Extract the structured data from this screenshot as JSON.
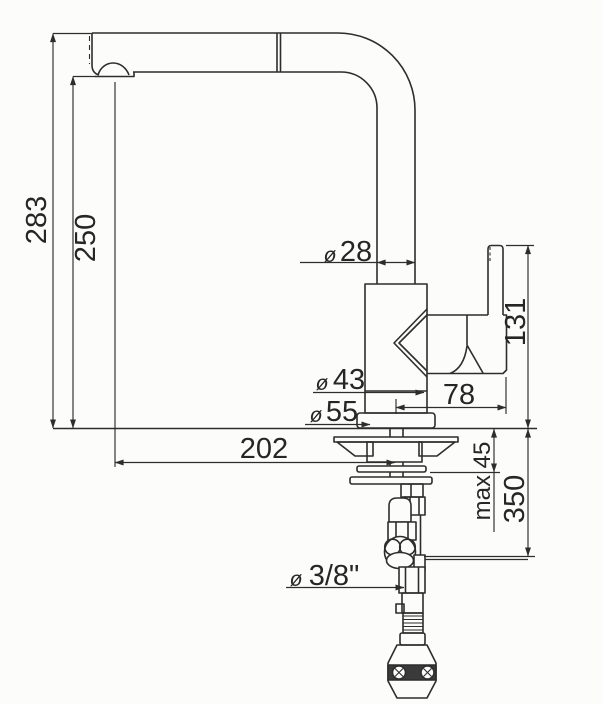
{
  "drawing": {
    "type": "technical-dimension-drawing",
    "subject": "kitchen mixer tap, side elevation with pull-out spray hose, weight and 3/8 inch supply connection",
    "units": "mm",
    "line_color": "#2d2d2d",
    "background_color": "#fcfcfa",
    "labels": {
      "total_height": "283",
      "spout_underside_height": "250",
      "spout_reach": "202",
      "spout_tube_diameter_symbol": "ø",
      "spout_tube_diameter": "28",
      "handle_top_height": "131",
      "body_offset": "78",
      "body_diameter_symbol": "ø",
      "body_diameter": "43",
      "base_diameter_symbol": "ø",
      "base_diameter": "55",
      "max_counter_thickness": "max 45",
      "hose_drop": "350",
      "supply_connection_symbol": "ø",
      "supply_connection": "3/8\""
    }
  }
}
